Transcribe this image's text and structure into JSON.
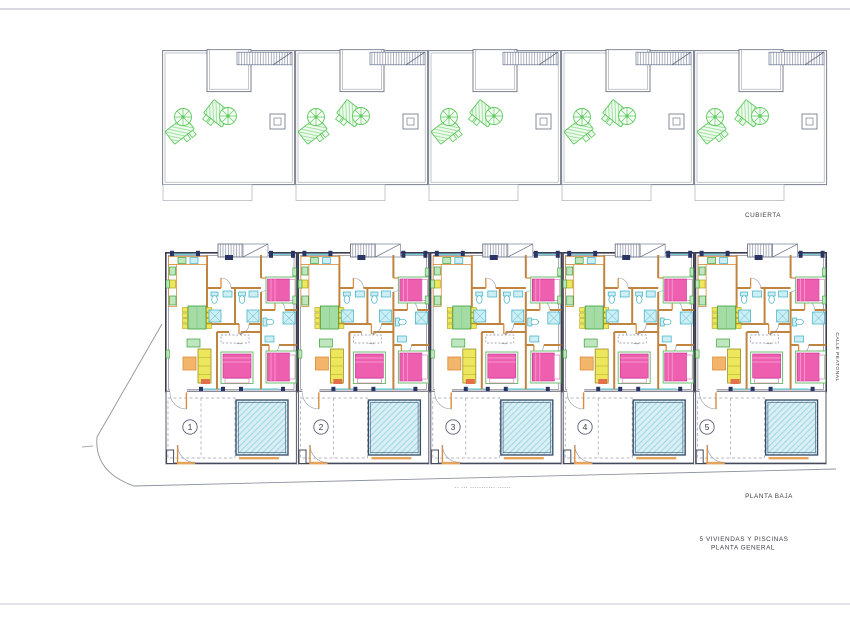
{
  "plan": {
    "roof": {
      "label": "CUBIERTA",
      "unit_count": "5"
    },
    "ground": {
      "label": "PLANTA BAJA",
      "units": [
        {
          "number": "1"
        },
        {
          "number": "2"
        },
        {
          "number": "3"
        },
        {
          "number": "4"
        },
        {
          "number": "5"
        }
      ]
    },
    "streets": {
      "side_vertical_label": "CALLE PEATONAL",
      "bottom_faint_label": "-- ---   -----------  ------"
    },
    "title": {
      "line1": "5 VIVIENDAS Y PISCINAS",
      "line2": "PLANTA GENERAL"
    },
    "colors": {
      "bed_pink": "#ef5fb0",
      "sanitary_cyan": "#39b0c4",
      "pool_fill": "#d9eff5",
      "pool_hatch": "#9ed7e2",
      "furniture_green": "#39a039",
      "sofa_yellow": "#ece75d",
      "partition_orange": "#c08441",
      "roof_symbol_green": "#5fca5f",
      "exterior_wall": "#3c3c50"
    }
  }
}
